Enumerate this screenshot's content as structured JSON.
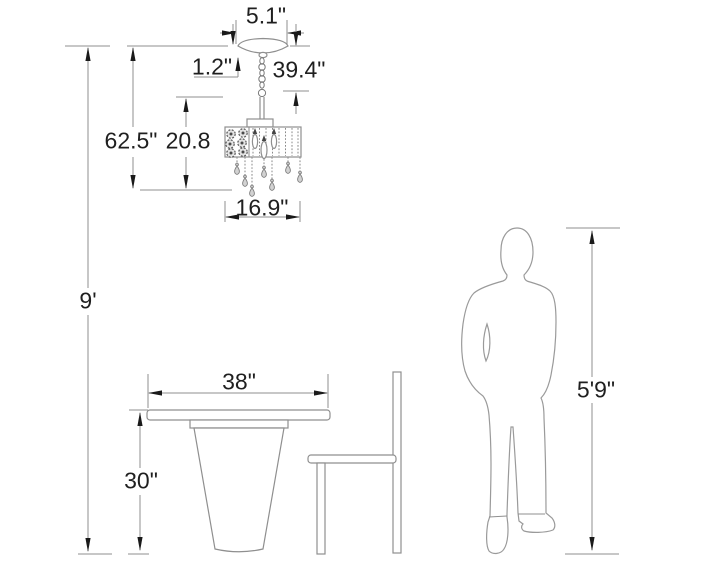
{
  "diagram": {
    "description": "Product dimension diagram: crystal drum chandelier hanging above a pedestal dining table with chair, human figure shown for scale",
    "labels": {
      "canopy_width": "5.1\"",
      "canopy_height": "1.2\"",
      "hanging_length": "39.4\"",
      "overall_height": "62.5\"",
      "fixture_height": "20.8",
      "fixture_width": "16.9\"",
      "ceiling_height": "9'",
      "table_width": "38\"",
      "table_height": "30\"",
      "person_height": "5'9\""
    },
    "colors": {
      "background": "#ffffff",
      "line": "#8f8f8f",
      "text": "#1f1f1f",
      "arrowhead": "#1a1a1a",
      "crystal_fill": "#d2d2d2"
    }
  }
}
